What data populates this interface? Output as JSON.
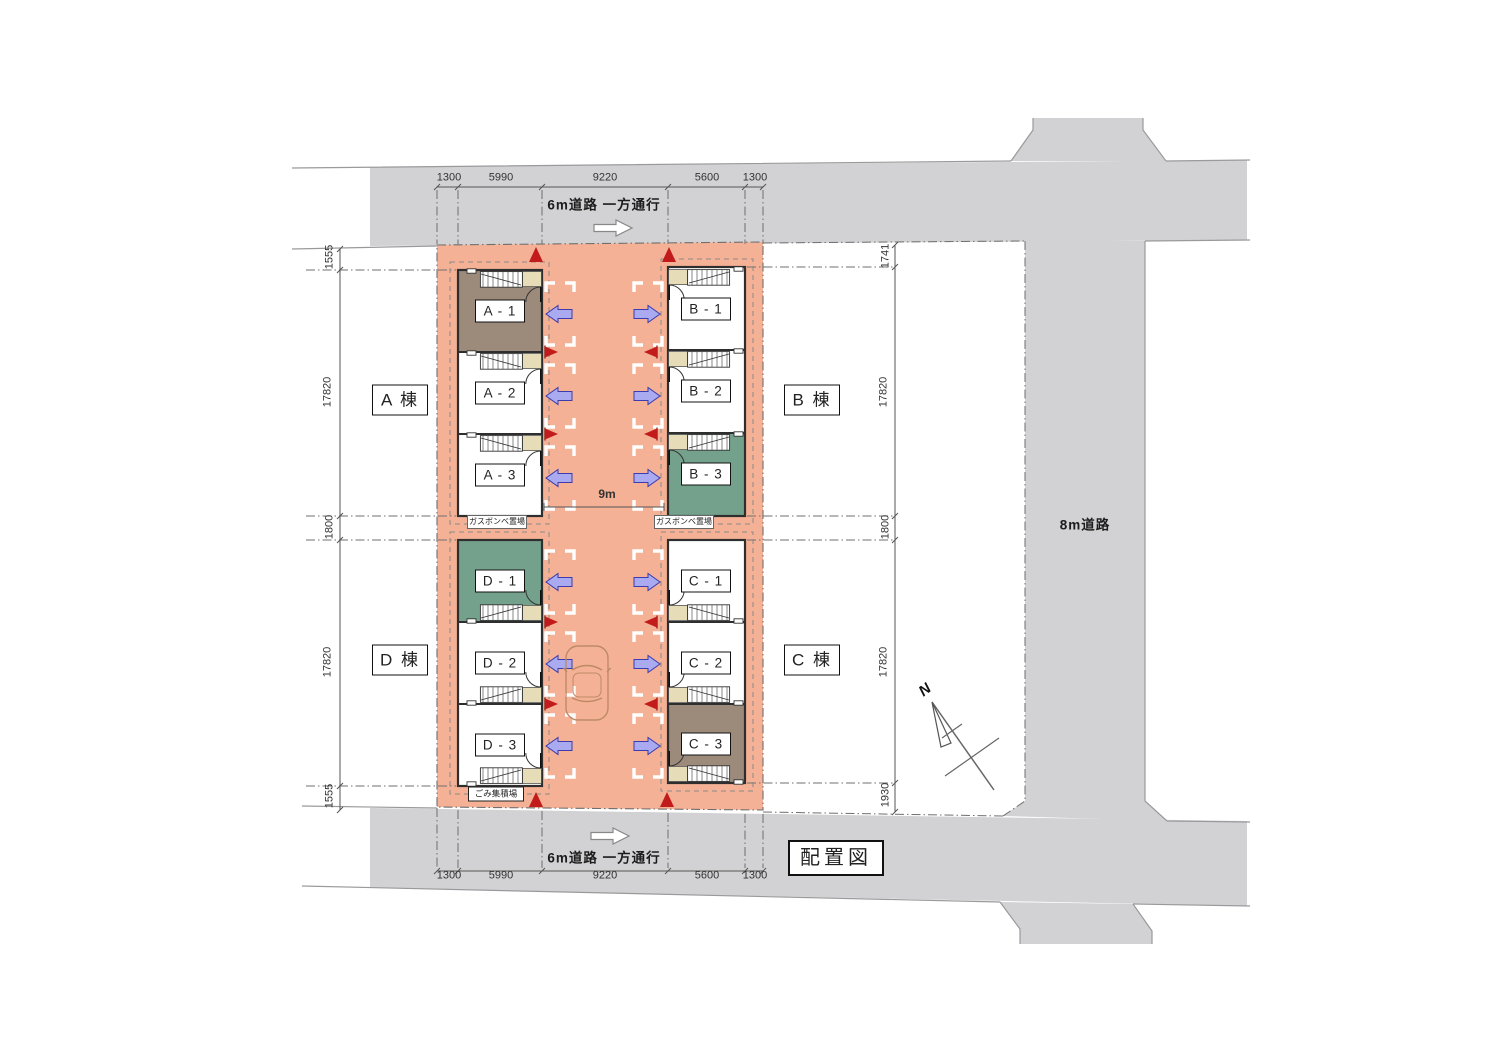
{
  "drawing_title": "配置図",
  "compass_label": "N",
  "roads": {
    "top_label": "6m道路 一方通行",
    "bottom_label": "6m道路 一方通行",
    "right_label": "8m道路",
    "drive_width_label": "9m"
  },
  "blocks": [
    {
      "id": "A",
      "label": "A 棟"
    },
    {
      "id": "B",
      "label": "B 棟"
    },
    {
      "id": "D",
      "label": "D 棟"
    },
    {
      "id": "C",
      "label": "C 棟"
    }
  ],
  "units": [
    {
      "id": "A-1",
      "label": "A - 1",
      "highlight": "brown"
    },
    {
      "id": "A-2",
      "label": "A - 2",
      "highlight": "none"
    },
    {
      "id": "A-3",
      "label": "A - 3",
      "highlight": "none"
    },
    {
      "id": "B-1",
      "label": "B - 1",
      "highlight": "none"
    },
    {
      "id": "B-2",
      "label": "B - 2",
      "highlight": "none"
    },
    {
      "id": "B-3",
      "label": "B - 3",
      "highlight": "green"
    },
    {
      "id": "D-1",
      "label": "D - 1",
      "highlight": "green"
    },
    {
      "id": "D-2",
      "label": "D - 2",
      "highlight": "none"
    },
    {
      "id": "D-3",
      "label": "D - 3",
      "highlight": "none"
    },
    {
      "id": "C-1",
      "label": "C - 1",
      "highlight": "none"
    },
    {
      "id": "C-2",
      "label": "C - 2",
      "highlight": "none"
    },
    {
      "id": "C-3",
      "label": "C - 3",
      "highlight": "brown"
    }
  ],
  "facilities": {
    "gas_storage_left": "ガスボンベ置場",
    "gas_storage_right": "ガスボンベ置場",
    "garbage_station": "ごみ集積場"
  },
  "dimensions": {
    "top": [
      "1300",
      "5990",
      "9220",
      "5600",
      "1300"
    ],
    "bottom": [
      "1300",
      "5990",
      "9220",
      "5600",
      "1300"
    ],
    "left": [
      "1555",
      "17820",
      "1800",
      "17820",
      "1555"
    ],
    "right": [
      "1741",
      "17820",
      "1800",
      "17820",
      "1930"
    ]
  },
  "colors": {
    "road": "#d2d2d4",
    "site": "#f4b195",
    "unit_brown": "#9c8b7b",
    "unit_green": "#74a18c",
    "arrow_blue": "#a9aaf0",
    "flag_red": "#c11b1b",
    "entry_beige": "#e6dcb8"
  }
}
